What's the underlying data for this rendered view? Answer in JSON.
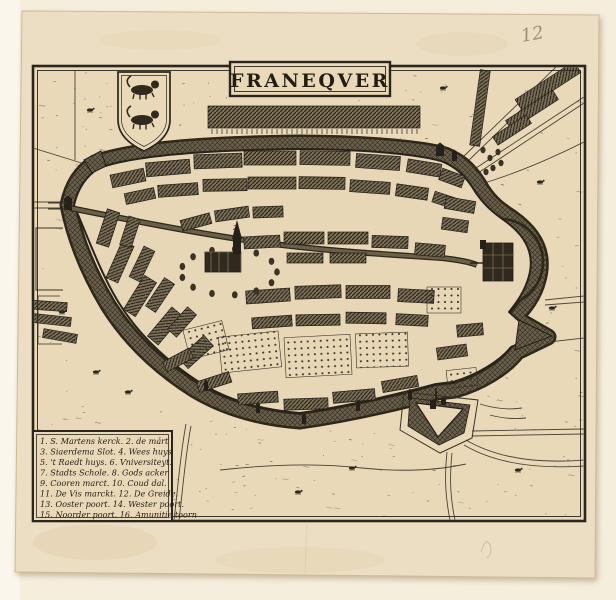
{
  "artifact": {
    "title": "FRANEQVER",
    "handwritten_number": "12",
    "legend_lines": [
      "1. S. Martens kerck. 2. de márt",
      "3. Siaerdema Slot. 4. Wees huys",
      "5. 't Raedt huys. 6. Vniversiteyt.",
      "7. Stadts Schole. 8. Gods acker",
      "9. Cooren marct. 10. Coud dal.",
      "11. De Vis marckt. 12. De Greide.",
      "13. Ooster poort. 14. Wester poort.",
      "15. Noorder poort. 16. Amunitie toorn"
    ],
    "map_markers": [
      "2",
      "3",
      "5"
    ],
    "colors": {
      "background": "#f5eedd",
      "paper": "#ecdec2",
      "plate_paper": "#e9d9b9",
      "ink": "#2b261c",
      "moat": "#6a604a",
      "pencil": "#8d8270"
    }
  }
}
